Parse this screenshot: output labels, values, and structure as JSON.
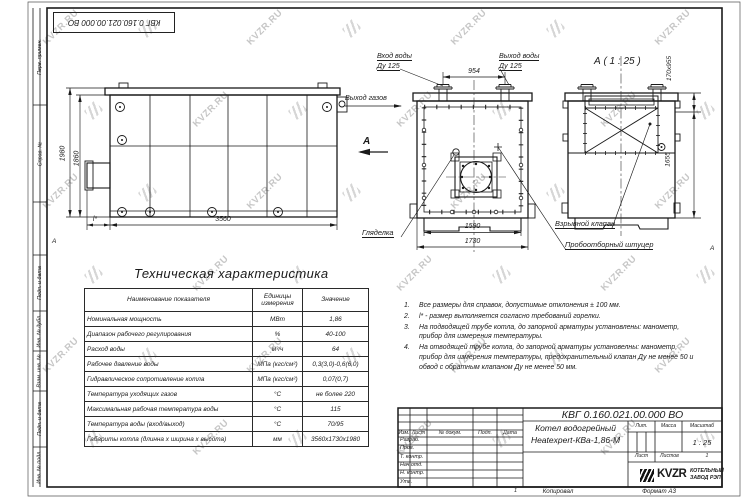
{
  "watermark": {
    "text": "KVZR.RU"
  },
  "page": {
    "zone_marker": "А",
    "copied_num": "1",
    "copied_label": "Копировал",
    "format_label": "Формат А3"
  },
  "side_strips": [
    "Перв. примен.",
    "Справ. №",
    "",
    "Подп. и дата",
    "Инв. № дубл.",
    "Взам. инв. №",
    "Подп. и дата",
    "Инв. № подл."
  ],
  "views": {
    "side": {
      "dim_height_outer": "1980",
      "dim_height_inner": "1860",
      "dim_length": "3560",
      "dim_burner": "l*"
    },
    "front": {
      "label_water_in": "Вход воды",
      "label_water_in_dn": "Ду 125",
      "label_water_out": "Выход воды",
      "label_water_out_dn": "Ду 125",
      "label_gas_out": "Выход газов",
      "label_view": "А",
      "label_sight": "Гляделка",
      "dim_pipes": "954",
      "dim_width_inner": "1590",
      "dim_width_outer": "1730"
    },
    "section": {
      "title": "А ( 1 : 25 )",
      "label_valve": "Взрывной клапан",
      "label_fitting": "Пробоотборный штуцер",
      "dim_valve": "170х955",
      "dim_height": "1655"
    }
  },
  "spec_table": {
    "title": "Техническая характеристика",
    "headers": [
      "Наименование показателя",
      "Единицы измерения",
      "Значение"
    ],
    "rows": [
      [
        "Номинальная мощность",
        "МВт",
        "1,86"
      ],
      [
        "Диапазон рабочего регулирования",
        "%",
        "40-100"
      ],
      [
        "Расход воды",
        "м³/ч",
        "64"
      ],
      [
        "Рабочее давление воды",
        "МПа (кгс/см²)",
        "0,3(3,0)-0,6(6,0)"
      ],
      [
        "Гидравлическое сопротивление котла",
        "МПа (кгс/см²)",
        "0,07(0,7)"
      ],
      [
        "Температура уходящих газов",
        "°С",
        "не более 220"
      ],
      [
        "Максимальная рабочая температура воды",
        "°С",
        "115"
      ],
      [
        "Температура воды (вход/выход)",
        "°С",
        "70/95"
      ],
      [
        "Габариты котла (длинна х ширина х высота)",
        "мм",
        "3560х1730х1980"
      ]
    ]
  },
  "notes": [
    {
      "n": "1.",
      "text": "Все размеры для справок, допустимые отклонения ± 100 мм."
    },
    {
      "n": "2.",
      "text": "l* - размер выполняется согласно требований горелки."
    },
    {
      "n": "3.",
      "text": "На подводящей трубе котла, до запорной арматуры установлены: манометр, прибор для измерения температуры."
    },
    {
      "n": "4.",
      "text": "На отводящей трубе котла, до запорной арматуры установелны: манометр, прибор для измерения температуры, предохранительный клапан Ду не менее 50 и обвод с обратным клапаном Ду не менее 50 мм."
    }
  ],
  "title_block": {
    "designation": "КВГ 0.160.021.00.000 ВО",
    "product_name_1": "Котел водогрейный",
    "product_name_2": "Heatexpert-КВа-1,86-М",
    "change_header": [
      "Изм.",
      "Лист",
      "№ докум.",
      "Подп.",
      "Дата"
    ],
    "roles": [
      "Разраб.",
      "Пров.",
      "Т. контр.",
      "Нач.отд.",
      "Н. контр.",
      "Утв."
    ],
    "lit_label": "Лит.",
    "mass_label": "Масса",
    "scale_label": "Масштаб",
    "scale_value": "1 : 25",
    "sheet_label": "Лист",
    "sheets_label": "Листов",
    "sheets_value": "1",
    "company_logo": "KVZR",
    "company_name_1": "КОТЕЛЬНЫЙ",
    "company_name_2": "ЗАВОД РЭП"
  }
}
